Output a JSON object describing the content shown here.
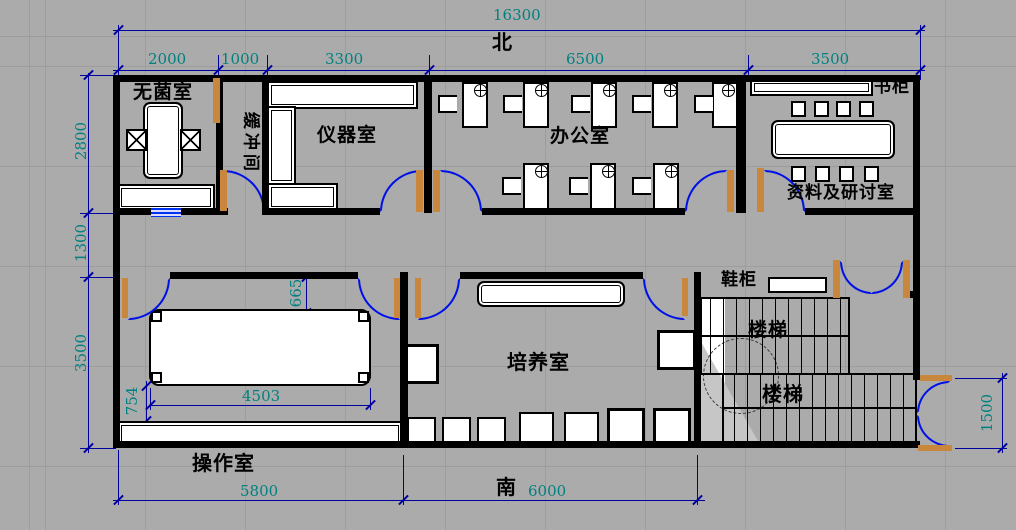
{
  "compass": {
    "north": "北",
    "south": "南"
  },
  "dimensions": {
    "overall_width": "16300",
    "top_segments": [
      "2000",
      "1000",
      "3300",
      "6500",
      "3500"
    ],
    "left_segments": [
      "2800",
      "1300",
      "3500"
    ],
    "bottom_segments": [
      "5800",
      "6000"
    ],
    "entrance_width": "1500",
    "operation_table_width": "4503",
    "operation_table_clearance": "754",
    "culture_door_clearance": "665"
  },
  "rooms": {
    "sterile": "无菌室",
    "buffer": "缓冲间",
    "instrument": "仪器室",
    "office": "办公室",
    "archive": "资料及研讨室",
    "culture": "培养室",
    "operation": "操作室",
    "stairs_upper": "楼梯",
    "stairs_lower": "楼梯"
  },
  "fixtures": {
    "bookcase": "书柜",
    "shoe_cabinet": "鞋柜"
  },
  "colors": {
    "background": "#ababab",
    "wall": "#000000",
    "dimension_line": "#00009f",
    "dimension_text": "#008080",
    "door_arc": "#0010e8",
    "door_leaf": "#c8873d"
  }
}
